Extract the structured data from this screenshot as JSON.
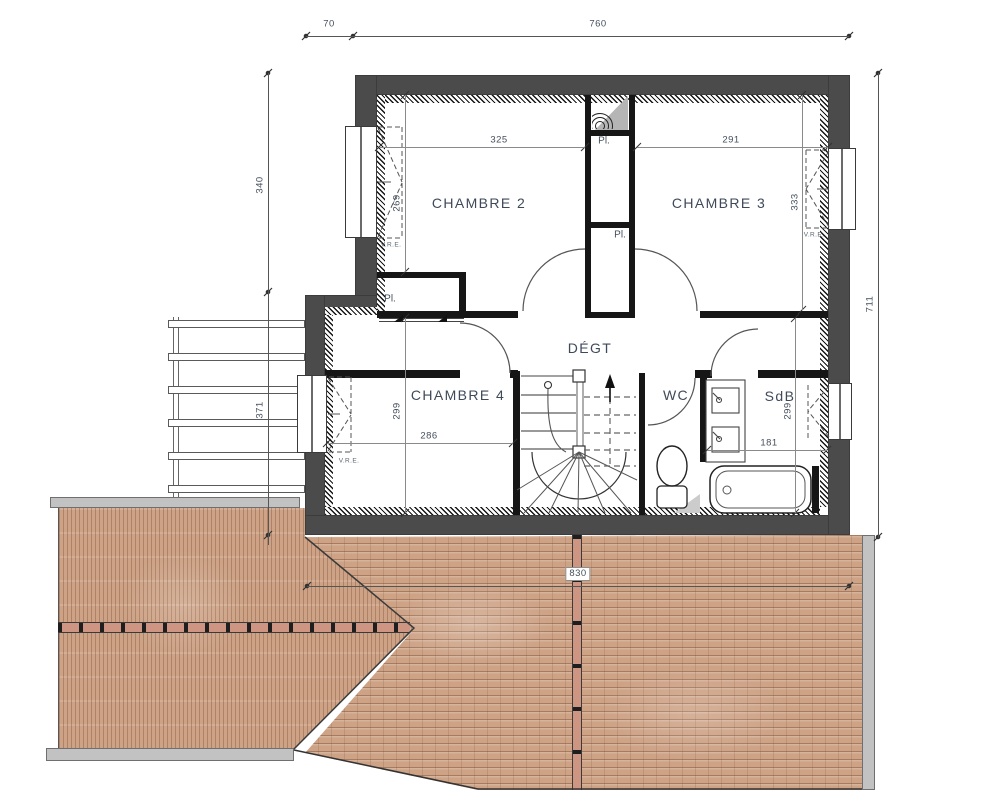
{
  "plan": {
    "rooms": {
      "chambre2": {
        "name": "CHAMBRE 2",
        "dim_w": "325",
        "dim_h": "269"
      },
      "chambre3": {
        "name": "CHAMBRE 3",
        "dim_w": "291",
        "dim_h": "333"
      },
      "chambre4": {
        "name": "CHAMBRE 4",
        "dim_w": "286",
        "dim_h": "299"
      },
      "degagement": {
        "name": "DÉGT"
      },
      "wc": {
        "name": "WC"
      },
      "sdb": {
        "name": "SdB",
        "dim_w": "181",
        "dim_h": "299"
      }
    },
    "labels": {
      "closet": "Pl.",
      "shutter": "V.R.E."
    },
    "dims": {
      "top_offset": "70",
      "top_main": "760",
      "left_upper": "340",
      "left_lower": "371",
      "right_total": "711",
      "roof_width": "830"
    },
    "colors": {
      "exterior_wall": "#4b4b4b",
      "partition": "#161616",
      "roof_tile": "#cda285",
      "ridge_tile": "#cf9583",
      "gutter": "#c2c2c2",
      "label_text": "#3f4a59"
    }
  }
}
